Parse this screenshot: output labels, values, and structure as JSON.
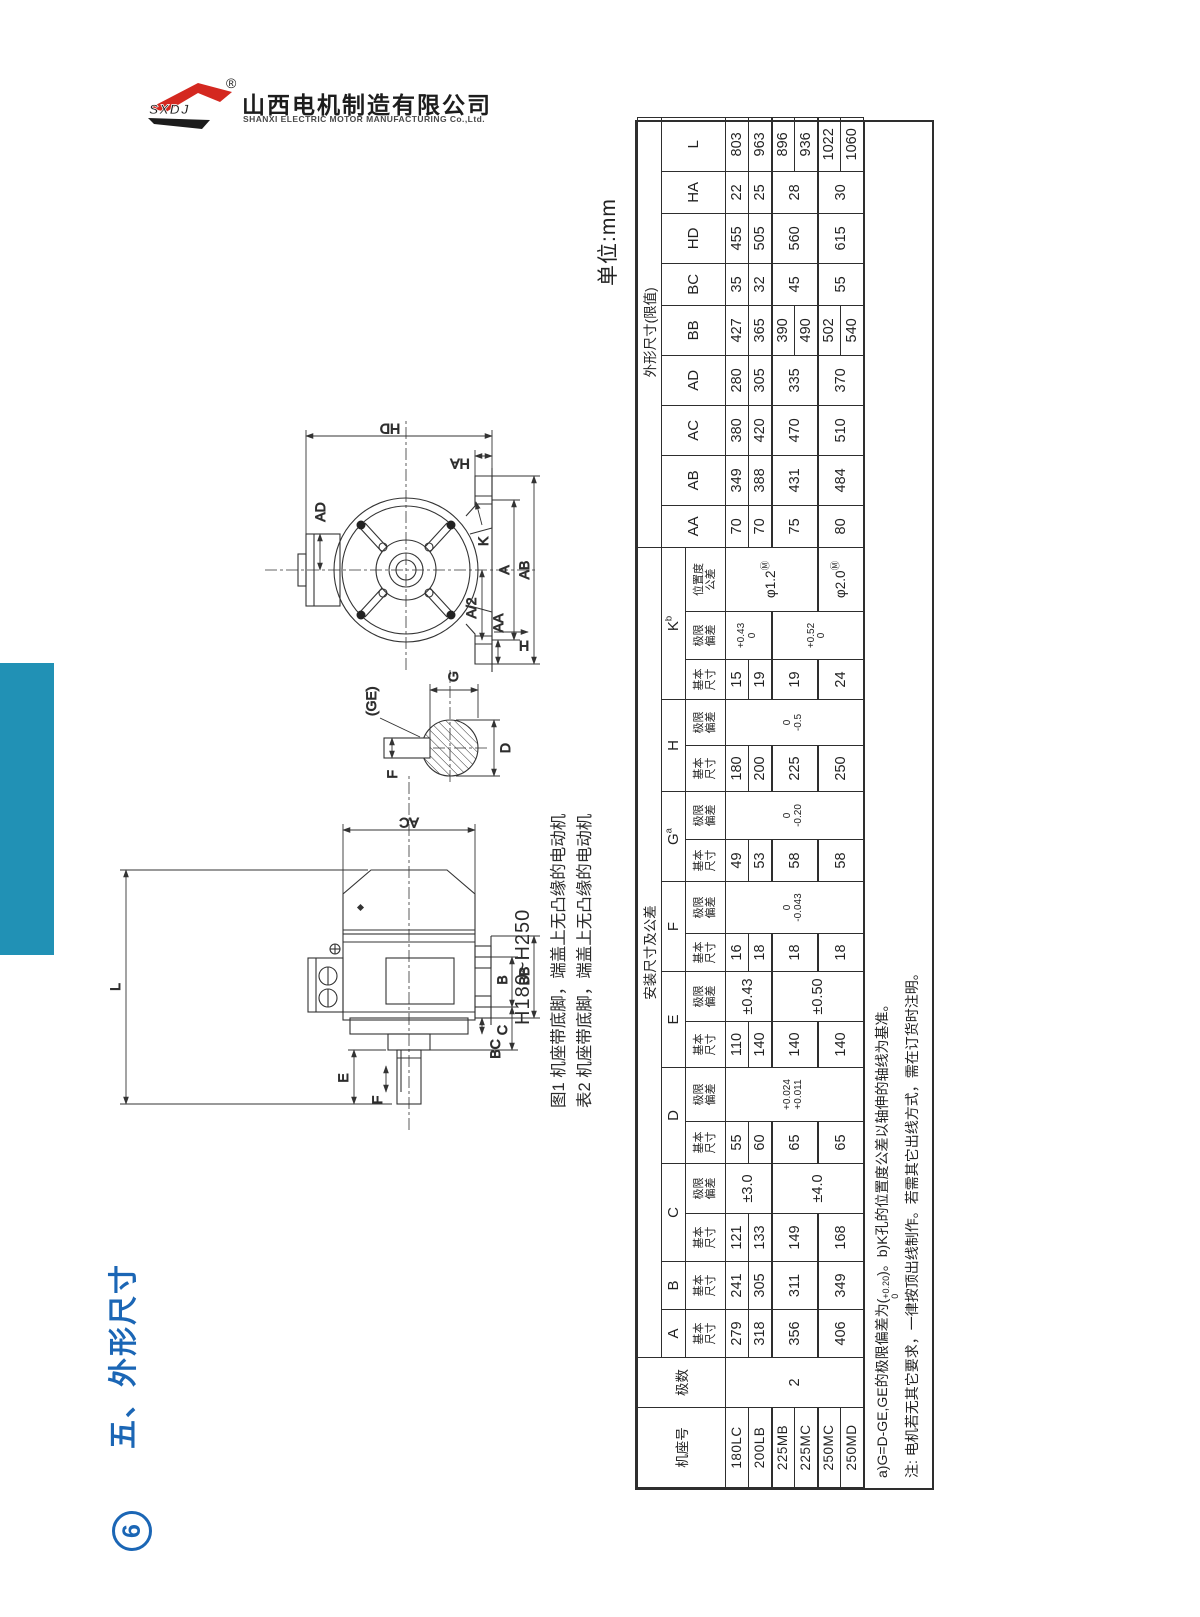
{
  "logo": {
    "mark": "SXDJ",
    "registered": "®",
    "company_cn": "山西电机制造有限公司",
    "company_en": "SHANXI ELECTRIC MOTOR MANUFACTURING Co.,Ltd."
  },
  "sidebar": {
    "section_title": "五、外形尺寸",
    "page_badge": "6"
  },
  "sheet": {
    "unit_label": "单位:mm",
    "frame_range": "H180~H250",
    "fig_caption": "图1 机座带底脚，端盖上无凸缘的电动机",
    "tbl_caption": "表2 机座带底脚，端盖上无凸缘的电动机"
  },
  "figure": {
    "side": {
      "L": "L",
      "AC": "AC",
      "E": "E",
      "F": "F",
      "B": "B",
      "BB": "BB",
      "C": "C",
      "BC": "BC"
    },
    "end": {
      "HD": "HD",
      "HA": "HA",
      "AD": "AD",
      "K": "K",
      "A": "A",
      "A2": "A/2",
      "AA": "AA",
      "AB": "AB",
      "H": "H"
    },
    "shaft": {
      "F": "F",
      "GE": "(GE)",
      "G": "G",
      "D": "D"
    }
  },
  "table": {
    "col_widths": [
      80,
      50,
      48,
      48,
      48,
      50,
      42,
      54,
      46,
      50,
      38,
      52,
      42,
      48,
      46,
      46,
      40,
      48,
      64,
      42,
      50,
      50,
      50,
      50,
      42,
      50,
      42,
      54
    ],
    "header": [
      [
        {
          "t": "机座号",
          "rs": 3,
          "cl": "hcn"
        },
        {
          "t": "极数",
          "rs": 3,
          "cl": "hcn"
        },
        {
          "t": "安装尺寸及公差",
          "cs": 17,
          "cl": "hcn"
        },
        {
          "t": "外形尺寸(限值)",
          "cs": 9,
          "cl": "hcn"
        }
      ],
      [
        {
          "t": "A",
          "cl": "hl"
        },
        {
          "t": "B",
          "cl": "hl"
        },
        {
          "t": "C",
          "cs": 2,
          "cl": "hl"
        },
        {
          "t": "D",
          "cs": 2,
          "cl": "hl"
        },
        {
          "t": "E",
          "cs": 2,
          "cl": "hl"
        },
        {
          "t": "F",
          "cs": 2,
          "cl": "hl"
        },
        {
          "t": "G",
          "sup": "a",
          "cs": 2,
          "cl": "hl"
        },
        {
          "t": "H",
          "cs": 2,
          "cl": "hl"
        },
        {
          "t": "K",
          "sup": "b",
          "cs": 3,
          "cl": "hl"
        },
        {
          "t": "AA",
          "rs": 2,
          "cl": "hl"
        },
        {
          "t": "AB",
          "rs": 2,
          "cl": "hl"
        },
        {
          "t": "AC",
          "rs": 2,
          "cl": "hl"
        },
        {
          "t": "AD",
          "rs": 2,
          "cl": "hl"
        },
        {
          "t": "BB",
          "rs": 2,
          "cl": "hl"
        },
        {
          "t": "BC",
          "rs": 2,
          "cl": "hl"
        },
        {
          "t": "HD",
          "rs": 2,
          "cl": "hl"
        },
        {
          "t": "HA",
          "rs": 2,
          "cl": "hl"
        },
        {
          "t": "L",
          "rs": 2,
          "cl": "hl"
        }
      ],
      [
        {
          "t": "基本\n尺寸",
          "cl": "sub"
        },
        {
          "t": "基本\n尺寸",
          "cl": "sub"
        },
        {
          "t": "基本\n尺寸",
          "cl": "sub"
        },
        {
          "t": "极限\n偏差",
          "cl": "sub"
        },
        {
          "t": "基本\n尺寸",
          "cl": "sub"
        },
        {
          "t": "极限\n偏差",
          "cl": "sub"
        },
        {
          "t": "基本\n尺寸",
          "cl": "sub"
        },
        {
          "t": "极限\n偏差",
          "cl": "sub"
        },
        {
          "t": "基本\n尺寸",
          "cl": "sub"
        },
        {
          "t": "极限\n偏差",
          "cl": "sub"
        },
        {
          "t": "基本\n尺寸",
          "cl": "sub"
        },
        {
          "t": "极限\n偏差",
          "cl": "sub"
        },
        {
          "t": "基本\n尺寸",
          "cl": "sub"
        },
        {
          "t": "极限\n偏差",
          "cl": "sub"
        },
        {
          "t": "基本\n尺寸",
          "cl": "sub"
        },
        {
          "t": "极限\n偏差",
          "cl": "sub"
        },
        {
          "t": "位置度\n公差",
          "cl": "sub"
        }
      ]
    ],
    "body": [
      {
        "c": [
          {
            "t": "180LC",
            "cl": "frame"
          },
          {
            "t": "2",
            "rs": 6,
            "cl": "num"
          },
          {
            "t": "279",
            "cl": "num"
          },
          {
            "t": "241",
            "cl": "num"
          },
          {
            "t": "121",
            "cl": "num"
          },
          {
            "t": "±3.0",
            "rs": 2,
            "cl": "num"
          },
          {
            "t": "55",
            "cl": "num"
          },
          {
            "t": "+0.024\n+0.011",
            "rs": 6,
            "cl": "tol"
          },
          {
            "t": "110",
            "cl": "num"
          },
          {
            "t": "±0.43",
            "rs": 2,
            "cl": "num"
          },
          {
            "t": "16",
            "cl": "num"
          },
          {
            "t": "0\n-0.043",
            "rs": 6,
            "cl": "tol"
          },
          {
            "t": "49",
            "cl": "num"
          },
          {
            "t": "0\n-0.20",
            "rs": 6,
            "cl": "tol"
          },
          {
            "t": "180",
            "cl": "num"
          },
          {
            "t": "0\n-0.5",
            "rs": 6,
            "cl": "tol"
          },
          {
            "t": "15",
            "cl": "num"
          },
          {
            "t": "+0.43\n0",
            "rs": 2,
            "cl": "tol"
          },
          {
            "t": "φ1.2",
            "sup": "Ⓜ",
            "rs": 4,
            "cl": "pos"
          },
          {
            "t": "70",
            "cl": "num"
          },
          {
            "t": "349",
            "cl": "num"
          },
          {
            "t": "380",
            "cl": "num"
          },
          {
            "t": "280",
            "cl": "num"
          },
          {
            "t": "427",
            "cl": "num"
          },
          {
            "t": "35",
            "cl": "num"
          },
          {
            "t": "455",
            "cl": "num"
          },
          {
            "t": "22",
            "cl": "num"
          },
          {
            "t": "803",
            "cl": "num"
          }
        ]
      },
      {
        "c": [
          {
            "t": "200LB",
            "cl": "frame"
          },
          {
            "t": "318",
            "cl": "num"
          },
          {
            "t": "305",
            "cl": "num"
          },
          {
            "t": "133",
            "cl": "num"
          },
          {
            "t": "60",
            "cl": "num"
          },
          {
            "t": "140",
            "cl": "num"
          },
          {
            "t": "18",
            "cl": "num"
          },
          {
            "t": "53",
            "cl": "num"
          },
          {
            "t": "200",
            "cl": "num"
          },
          {
            "t": "19",
            "cl": "num"
          },
          {
            "t": "70",
            "cl": "num"
          },
          {
            "t": "388",
            "cl": "num"
          },
          {
            "t": "420",
            "cl": "num"
          },
          {
            "t": "305",
            "cl": "num"
          },
          {
            "t": "365",
            "cl": "num"
          },
          {
            "t": "32",
            "cl": "num"
          },
          {
            "t": "505",
            "cl": "num"
          },
          {
            "t": "25",
            "cl": "num"
          },
          {
            "t": "963",
            "cl": "num"
          }
        ]
      },
      {
        "g": true,
        "c": [
          {
            "t": "225MB",
            "cl": "frame"
          },
          {
            "t": "356",
            "rs": 2,
            "cl": "num"
          },
          {
            "t": "311",
            "rs": 2,
            "cl": "num"
          },
          {
            "t": "149",
            "rs": 2,
            "cl": "num"
          },
          {
            "t": "±4.0",
            "rs": 4,
            "cl": "num"
          },
          {
            "t": "65",
            "rs": 2,
            "cl": "num"
          },
          {
            "t": "140",
            "rs": 2,
            "cl": "num"
          },
          {
            "t": "±0.50",
            "rs": 4,
            "cl": "num"
          },
          {
            "t": "18",
            "rs": 2,
            "cl": "num"
          },
          {
            "t": "58",
            "rs": 2,
            "cl": "num"
          },
          {
            "t": "225",
            "rs": 2,
            "cl": "num"
          },
          {
            "t": "19",
            "rs": 2,
            "cl": "num"
          },
          {
            "t": "+0.52\n0",
            "rs": 4,
            "cl": "tol"
          },
          {
            "t": "75",
            "rs": 2,
            "cl": "num"
          },
          {
            "t": "431",
            "rs": 2,
            "cl": "num"
          },
          {
            "t": "470",
            "rs": 2,
            "cl": "num"
          },
          {
            "t": "335",
            "rs": 2,
            "cl": "num"
          },
          {
            "t": "390",
            "cl": "num"
          },
          {
            "t": "45",
            "rs": 2,
            "cl": "num"
          },
          {
            "t": "560",
            "rs": 2,
            "cl": "num"
          },
          {
            "t": "28",
            "rs": 2,
            "cl": "num"
          },
          {
            "t": "896",
            "cl": "num"
          }
        ]
      },
      {
        "c": [
          {
            "t": "225MC",
            "cl": "frame"
          },
          {
            "t": "490",
            "cl": "num"
          },
          {
            "t": "936",
            "cl": "num"
          }
        ]
      },
      {
        "g": true,
        "c": [
          {
            "t": "250MC",
            "cl": "frame"
          },
          {
            "t": "406",
            "rs": 2,
            "cl": "num"
          },
          {
            "t": "349",
            "rs": 2,
            "cl": "num"
          },
          {
            "t": "168",
            "rs": 2,
            "cl": "num"
          },
          {
            "t": "65",
            "rs": 2,
            "cl": "num"
          },
          {
            "t": "140",
            "rs": 2,
            "cl": "num"
          },
          {
            "t": "18",
            "rs": 2,
            "cl": "num"
          },
          {
            "t": "58",
            "rs": 2,
            "cl": "num"
          },
          {
            "t": "250",
            "rs": 2,
            "cl": "num"
          },
          {
            "t": "24",
            "rs": 2,
            "cl": "num"
          },
          {
            "t": "φ2.0",
            "sup": "Ⓜ",
            "rs": 2,
            "cl": "pos"
          },
          {
            "t": "80",
            "rs": 2,
            "cl": "num"
          },
          {
            "t": "484",
            "rs": 2,
            "cl": "num"
          },
          {
            "t": "510",
            "rs": 2,
            "cl": "num"
          },
          {
            "t": "370",
            "rs": 2,
            "cl": "num"
          },
          {
            "t": "502",
            "cl": "num"
          },
          {
            "t": "55",
            "rs": 2,
            "cl": "num"
          },
          {
            "t": "615",
            "rs": 2,
            "cl": "num"
          },
          {
            "t": "30",
            "rs": 2,
            "cl": "num"
          },
          {
            "t": "1022",
            "cl": "num"
          }
        ]
      },
      {
        "c": [
          {
            "t": "250MD",
            "cl": "frame"
          },
          {
            "t": "540",
            "cl": "num"
          },
          {
            "t": "1060",
            "cl": "num"
          }
        ]
      }
    ],
    "notes": {
      "a_pre": "a)G=D-GE,GE的极限偏差为(",
      "a_sup": "+0.20",
      "a_sub": "0",
      "a_post": ")。b)K孔的位置度公差以轴伸的轴线为基准。",
      "line2": "注: 电机若无其它要求，一律按顶出线制作。若需其它出线方式，需在订货时注明。"
    }
  }
}
